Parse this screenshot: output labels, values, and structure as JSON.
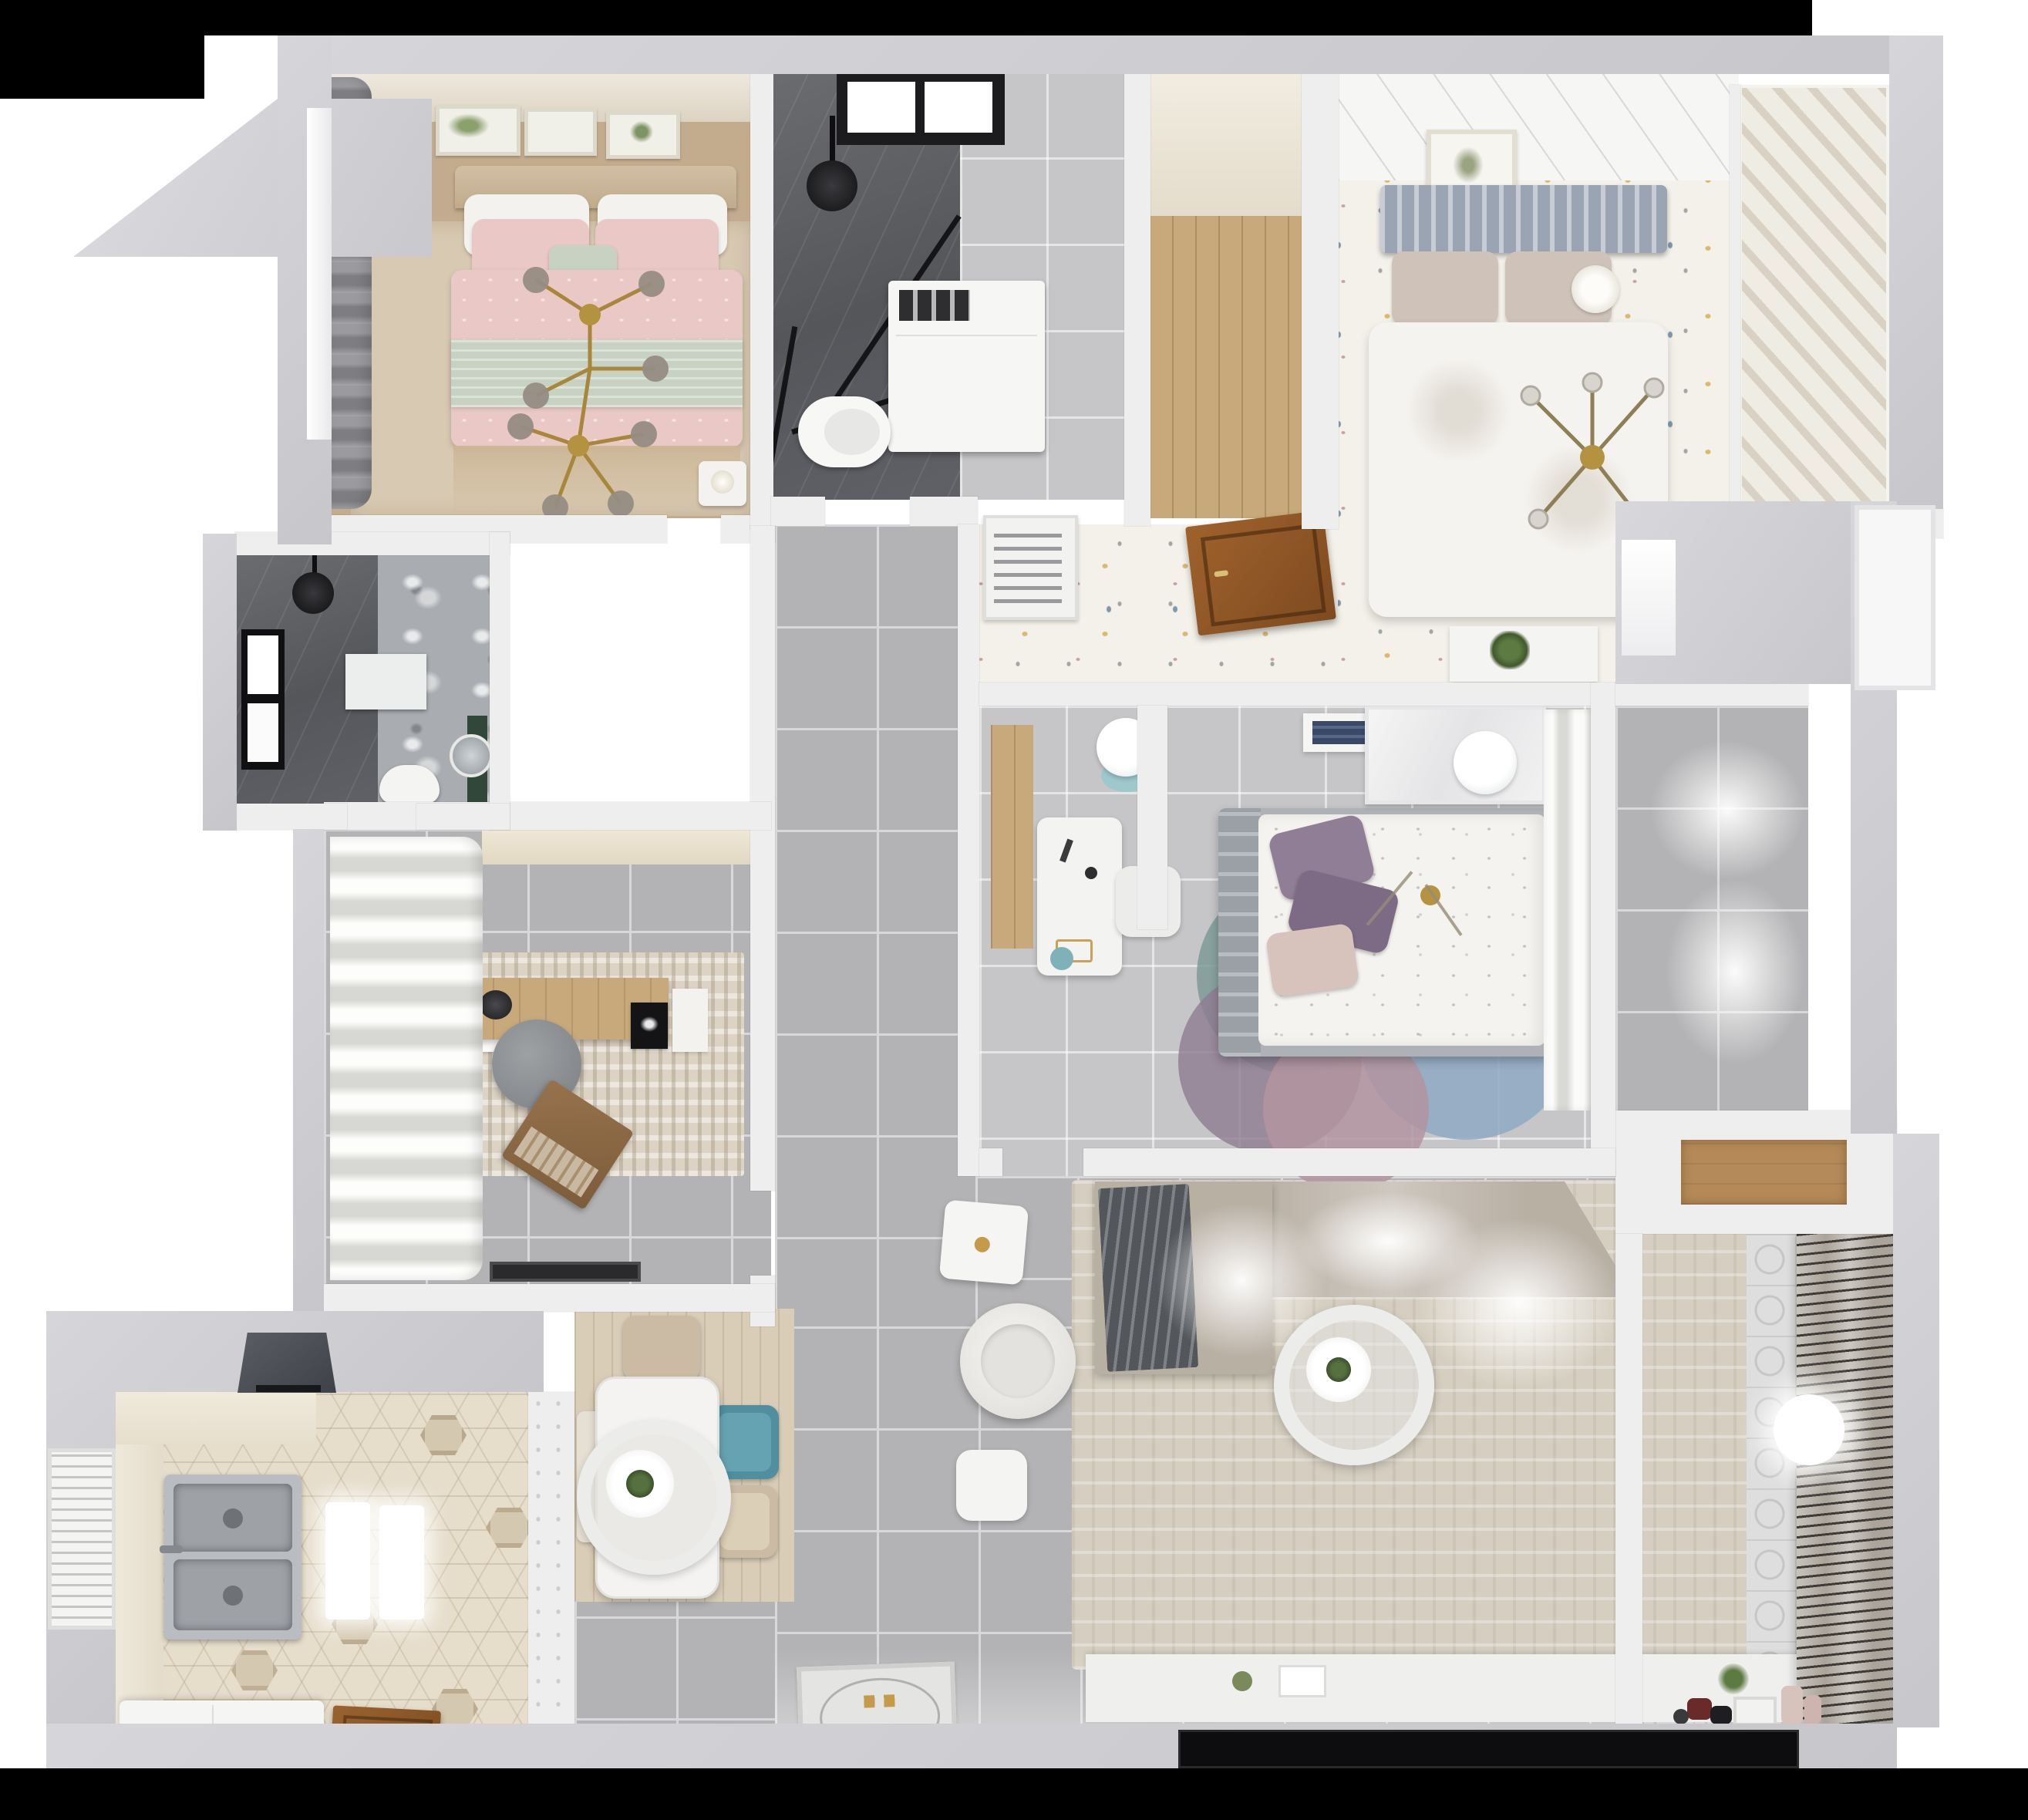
{
  "scene": {
    "kind": "3d-apartment-floor-plan-top-down-render",
    "visible_text": "none",
    "style": "photorealistic dollhouse view, white background, black letterbox bands top and bottom"
  },
  "colors": {
    "background": "#ffffff",
    "letterbox": "#000000",
    "outer_wall": "#c7c7cb",
    "inner_wall": "#eeeeef",
    "grey_tile": "#b3b2b4",
    "light_tile": "#c6c5c7",
    "master_floor_tan": "#c3ab8d",
    "master_rug": "#d8c9b2",
    "pink_duvet": "#eac8c5",
    "sage_blanket": "#c8d2c2",
    "gold_chandelier": "#a8873c",
    "dark_bath_tile": "#5e6064",
    "marble": "#a9adb1",
    "nook_wood": "#c8a97c",
    "confetti_floor": "#f4f1ea",
    "headboard_slat": "#9aa4b3",
    "white_duvet": "#f5f3f0",
    "closet_chevron": "#d9d2c4",
    "wood_door": "#8f562b",
    "study_rug": "#dcd3c4",
    "office_chair": "#8a8d90",
    "laptop": "#8a6a48",
    "kitchen_hex": "#e6ddcb",
    "sink_steel": "#b9bcc0",
    "dining_mat": "#d9cdb8",
    "teal_chair": "#4f8fa0",
    "beige_chair": "#cbbba4",
    "bed_frame": "#aeb2b6",
    "plum_pillow": "#8f7e95",
    "blush_pillow": "#d8c2bc",
    "rug_teal": "#7e9a96",
    "rug_plum": "#8f7d92",
    "rug_blue": "#8fa9c4",
    "rug_rose": "#b394a0",
    "sofa": "#b9b0a4",
    "sofa_throw": "#53575c",
    "living_rug": "#d6cfc1",
    "tv": "#0d0d0f",
    "balcony_tile": "#dedede",
    "balcony_blinds": "#3f3c38",
    "plant_green": "#4e6b3a",
    "lamp_teal_base": "#9fc8cc"
  },
  "rooms": {
    "master_bedroom": {
      "name": "Master bedroom",
      "furniture": [
        "double bed with pink bedding",
        "gold branch chandelier",
        "three botanical wall frames",
        "grey drape and window",
        "nightstand",
        "beige rug"
      ]
    },
    "bathroom_top": {
      "name": "Bathroom with walk-in shower",
      "furniture": [
        "skylight window",
        "black shower head",
        "glass shower screen",
        "washing machine",
        "toilet"
      ]
    },
    "wardrobe_nook": {
      "name": "Wardrobe nook",
      "furniture": [
        "wood plank floor"
      ]
    },
    "bedroom_right": {
      "name": "Second bedroom",
      "furniture": [
        "bed with slatted headboard",
        "white duvet",
        "cross chandelier",
        "wall picture",
        "chevron wardrobe closet",
        "confetti wallpaper floor"
      ]
    },
    "hallway_confetti": {
      "name": "Upper hallway",
      "furniture": [
        "AC louver grille",
        "open wooden door leaf",
        "shelf with plant"
      ]
    },
    "bathroom_left": {
      "name": "Shower room",
      "furniture": [
        "window",
        "black shower head",
        "wall niche",
        "toilet",
        "green vanity with round mirror"
      ]
    },
    "study": {
      "name": "Study",
      "furniture": [
        "billowy curtains",
        "wood desk",
        "office chair",
        "laptop",
        "speckled rug",
        "door mat",
        "cream cabinet"
      ]
    },
    "bedroom_center": {
      "name": "Main bedroom",
      "furniture": [
        "bed with floral duvet and plum pillows",
        "layered round rugs",
        "white desk and chair",
        "teal-based lamps",
        "wardrobe",
        "book shelf",
        "sheer curtains"
      ]
    },
    "corridor": {
      "name": "Corridor",
      "furniture": [
        "large grey floor tiles"
      ]
    },
    "dining": {
      "name": "Dining area",
      "furniture": [
        "white dining table",
        "ring pendant lamp with plant",
        "teal chair",
        "two beige chairs",
        "bench",
        "wood mat"
      ]
    },
    "kitchen": {
      "name": "Kitchen",
      "furniture": [
        "range hood",
        "double stainless sink",
        "counters",
        "two ceiling light pools",
        "hexagon tile floor",
        "window blinds",
        "wooden door leaf",
        "island counter"
      ]
    },
    "living": {
      "name": "Living room",
      "furniture": [
        "sectional sofa with grey throw",
        "beige rug",
        "ring pendant lamp",
        "round armchair",
        "white cube stool",
        "side table",
        "TV console",
        "flat TV panel",
        "entry doormat"
      ]
    },
    "balcony": {
      "name": "Balcony",
      "furniture": [
        "patterned tile floor",
        "louvered blinds",
        "glowing ball lamp",
        "toys",
        "small bench",
        "vases",
        "wood storage shelf"
      ]
    }
  }
}
